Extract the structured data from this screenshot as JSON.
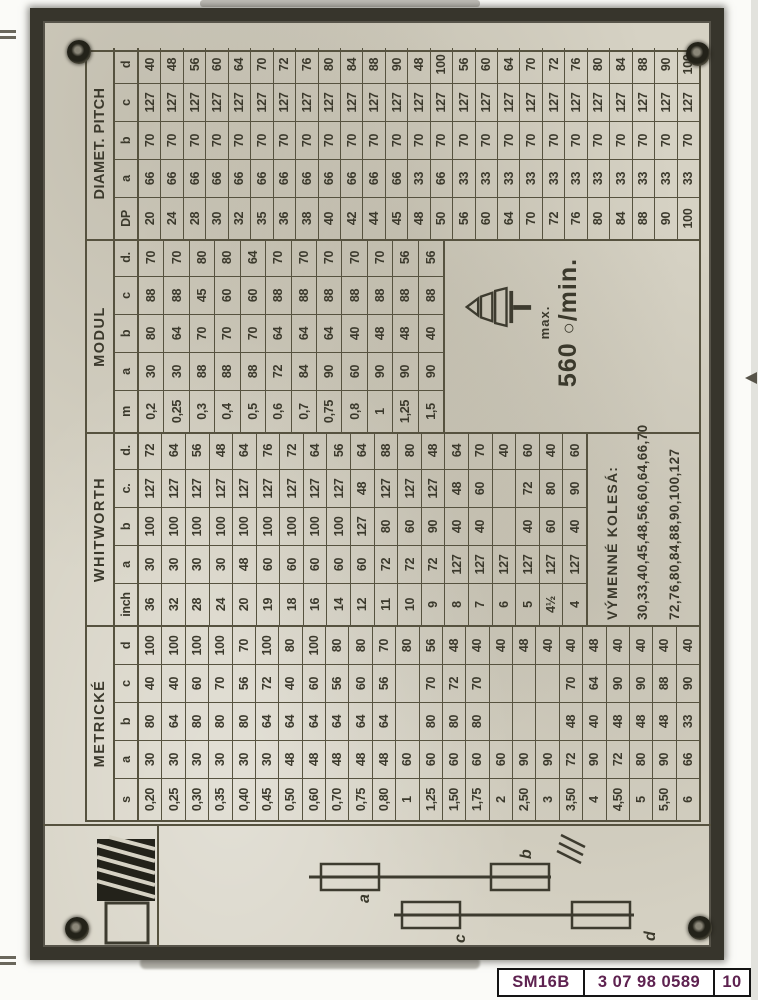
{
  "plate": {
    "sections": [
      {
        "name": "METRICKÉ",
        "col_labels": [
          "s",
          "a",
          "b",
          "c",
          "d"
        ],
        "rows": [
          [
            "0,20",
            "30",
            "80",
            "40",
            "100"
          ],
          [
            "0,25",
            "30",
            "64",
            "40",
            "100"
          ],
          [
            "0,30",
            "30",
            "80",
            "60",
            "100"
          ],
          [
            "0,35",
            "30",
            "80",
            "70",
            "100"
          ],
          [
            "0,40",
            "30",
            "80",
            "56",
            "70"
          ],
          [
            "0,45",
            "30",
            "64",
            "72",
            "100"
          ],
          [
            "0,50",
            "48",
            "64",
            "40",
            "80"
          ],
          [
            "0,60",
            "48",
            "64",
            "60",
            "100"
          ],
          [
            "0,70",
            "48",
            "64",
            "56",
            "80"
          ],
          [
            "0,75",
            "48",
            "64",
            "60",
            "80"
          ],
          [
            "0,80",
            "48",
            "64",
            "56",
            "70"
          ],
          [
            "1",
            "60",
            "",
            "",
            "80"
          ],
          [
            "1,25",
            "60",
            "80",
            "70",
            "56"
          ],
          [
            "1,50",
            "60",
            "80",
            "72",
            "48"
          ],
          [
            "1,75",
            "60",
            "80",
            "70",
            "40"
          ],
          [
            "2",
            "60",
            "",
            "",
            "40"
          ],
          [
            "2,50",
            "90",
            "",
            "",
            "48"
          ],
          [
            "3",
            "90",
            "",
            "",
            "40"
          ],
          [
            "3,50",
            "72",
            "48",
            "70",
            "40"
          ],
          [
            "4",
            "90",
            "40",
            "64",
            "48"
          ],
          [
            "4,50",
            "72",
            "48",
            "90",
            "40"
          ],
          [
            "5",
            "80",
            "48",
            "90",
            "40"
          ],
          [
            "5,50",
            "90",
            "48",
            "88",
            "40"
          ],
          [
            "6",
            "66",
            "33",
            "90",
            "40"
          ]
        ]
      },
      {
        "name": "WHITWORTH",
        "col_labels": [
          "inch",
          "a",
          "b",
          "c.",
          "d."
        ],
        "rows": [
          [
            "36",
            "30",
            "100",
            "127",
            "72"
          ],
          [
            "32",
            "30",
            "100",
            "127",
            "64"
          ],
          [
            "28",
            "30",
            "100",
            "127",
            "56"
          ],
          [
            "24",
            "30",
            "100",
            "127",
            "48"
          ],
          [
            "20",
            "48",
            "100",
            "127",
            "64"
          ],
          [
            "19",
            "60",
            "100",
            "127",
            "76"
          ],
          [
            "18",
            "60",
            "100",
            "127",
            "72"
          ],
          [
            "16",
            "60",
            "100",
            "127",
            "64"
          ],
          [
            "14",
            "60",
            "100",
            "127",
            "56"
          ],
          [
            "12",
            "60",
            "127",
            "48",
            "64"
          ],
          [
            "11",
            "72",
            "80",
            "127",
            "88"
          ],
          [
            "10",
            "72",
            "60",
            "127",
            "80"
          ],
          [
            "9",
            "72",
            "90",
            "127",
            "48"
          ],
          [
            "8",
            "127",
            "40",
            "48",
            "64"
          ],
          [
            "7",
            "127",
            "40",
            "60",
            "70"
          ],
          [
            "6",
            "127",
            "",
            "",
            "40"
          ],
          [
            "5",
            "127",
            "40",
            "72",
            "60"
          ],
          [
            "4½",
            "127",
            "60",
            "80",
            "40"
          ],
          [
            "4",
            "127",
            "40",
            "90",
            "60"
          ]
        ]
      },
      {
        "name": "MODUL",
        "col_labels": [
          "m",
          "a",
          "b",
          "c",
          "d."
        ],
        "rows": [
          [
            "0,2",
            "30",
            "80",
            "88",
            "70"
          ],
          [
            "0,25",
            "30",
            "64",
            "88",
            "70"
          ],
          [
            "0,3",
            "88",
            "70",
            "45",
            "80"
          ],
          [
            "0,4",
            "88",
            "70",
            "60",
            "80"
          ],
          [
            "0,5",
            "88",
            "70",
            "60",
            "64"
          ],
          [
            "0,6",
            "72",
            "64",
            "88",
            "70"
          ],
          [
            "0,7",
            "84",
            "64",
            "88",
            "70"
          ],
          [
            "0,75",
            "90",
            "64",
            "88",
            "70"
          ],
          [
            "0,8",
            "60",
            "40",
            "88",
            "70"
          ],
          [
            "1",
            "90",
            "48",
            "88",
            "70"
          ],
          [
            "1,25",
            "90",
            "48",
            "88",
            "56"
          ],
          [
            "1,5",
            "90",
            "40",
            "88",
            "56"
          ]
        ]
      },
      {
        "name": "DIAMET. PITCH",
        "col_labels": [
          "DP",
          "a",
          "b",
          "c",
          "d"
        ],
        "rows": [
          [
            "20",
            "66",
            "70",
            "127",
            "40"
          ],
          [
            "24",
            "66",
            "70",
            "127",
            "48"
          ],
          [
            "28",
            "66",
            "70",
            "127",
            "56"
          ],
          [
            "30",
            "66",
            "70",
            "127",
            "60"
          ],
          [
            "32",
            "66",
            "70",
            "127",
            "64"
          ],
          [
            "35",
            "66",
            "70",
            "127",
            "70"
          ],
          [
            "36",
            "66",
            "70",
            "127",
            "72"
          ],
          [
            "38",
            "66",
            "70",
            "127",
            "76"
          ],
          [
            "40",
            "66",
            "70",
            "127",
            "80"
          ],
          [
            "42",
            "66",
            "70",
            "127",
            "84"
          ],
          [
            "44",
            "66",
            "70",
            "127",
            "88"
          ],
          [
            "45",
            "66",
            "70",
            "127",
            "90"
          ],
          [
            "48",
            "33",
            "70",
            "127",
            "48"
          ],
          [
            "50",
            "66",
            "70",
            "127",
            "100"
          ],
          [
            "56",
            "33",
            "70",
            "127",
            "56"
          ],
          [
            "60",
            "33",
            "70",
            "127",
            "60"
          ],
          [
            "64",
            "33",
            "70",
            "127",
            "64"
          ],
          [
            "70",
            "33",
            "70",
            "127",
            "70"
          ],
          [
            "72",
            "33",
            "70",
            "127",
            "72"
          ],
          [
            "76",
            "33",
            "70",
            "127",
            "76"
          ],
          [
            "80",
            "33",
            "70",
            "127",
            "80"
          ],
          [
            "84",
            "33",
            "70",
            "127",
            "84"
          ],
          [
            "88",
            "33",
            "70",
            "127",
            "88"
          ],
          [
            "90",
            "33",
            "70",
            "127",
            "90"
          ],
          [
            "100",
            "33",
            "70",
            "127",
            "100"
          ]
        ]
      }
    ],
    "gear_note": {
      "title": "VÝMENNÉ KOLESÁ:",
      "row1": "30,33,40,45,48,56,60,64,66,70",
      "row2": "72,76,80,84,88,90,100,127"
    },
    "speed_note": {
      "label": "max.",
      "value": "560",
      "rev_symbol": "○",
      "unit": "/min."
    },
    "diagram": {
      "labels": [
        "a",
        "b",
        "c",
        "d"
      ]
    }
  },
  "footer": {
    "cells": [
      "SM16B",
      "3 07 98 0589",
      "10"
    ]
  }
}
